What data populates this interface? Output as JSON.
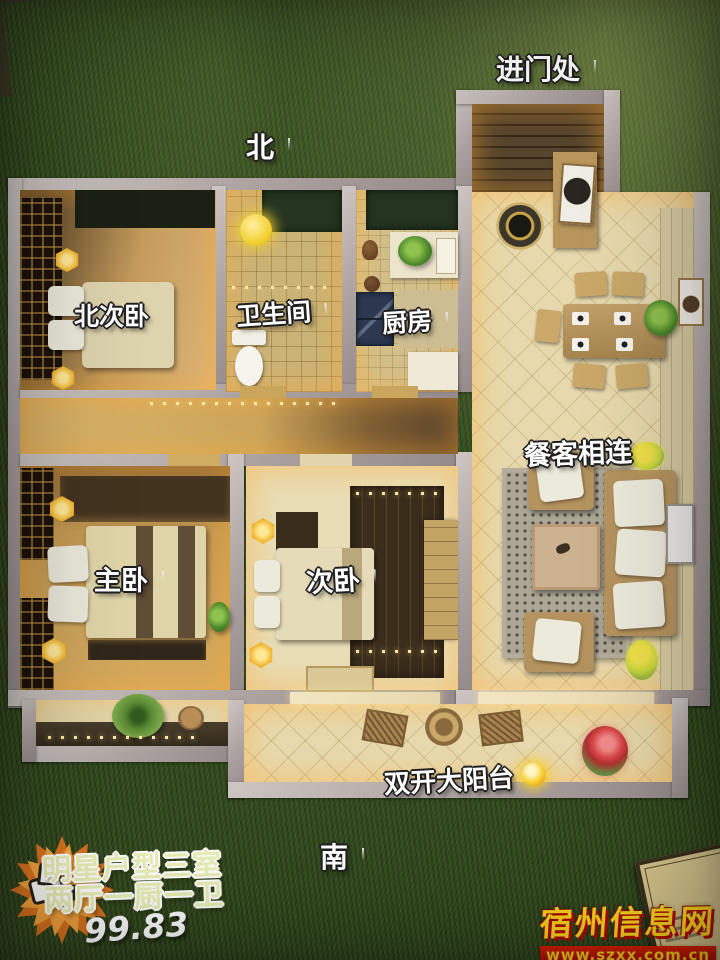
{
  "compass": {
    "north": "北",
    "south": "南"
  },
  "rooms": {
    "entrance": "进门处",
    "north_bedroom": "北次卧",
    "bathroom": "卫生间",
    "kitchen": "厨房",
    "dining_living": "餐客相连",
    "master_bedroom": "主卧",
    "second_bedroom": "次卧",
    "balcony": "双开大阳台"
  },
  "promo": {
    "line1": "明星户型三室",
    "line2": "两厅一厨一卫",
    "area_sqm": "99.83"
  },
  "watermark": {
    "site_name": "宿州信息网",
    "site_url": "www.szxx.com.cn"
  },
  "icons": {
    "pin": "red-pushpin-icon",
    "sun": "sun-icon",
    "thumbs_up": "thumbs-up-icon"
  },
  "colors": {
    "grass": "#36511f",
    "wall": "#ada3a1",
    "floor_warm_tan": "#cfa964",
    "tile_cream": "#e7d9ad",
    "pin_red": "#e02828",
    "lamp_gold": "#f3bf3a",
    "starburst_orange": "#f09a30",
    "promo_text": "#e9efb4",
    "watermark_yellow": "#ffd61f",
    "watermark_red": "#c81400"
  }
}
